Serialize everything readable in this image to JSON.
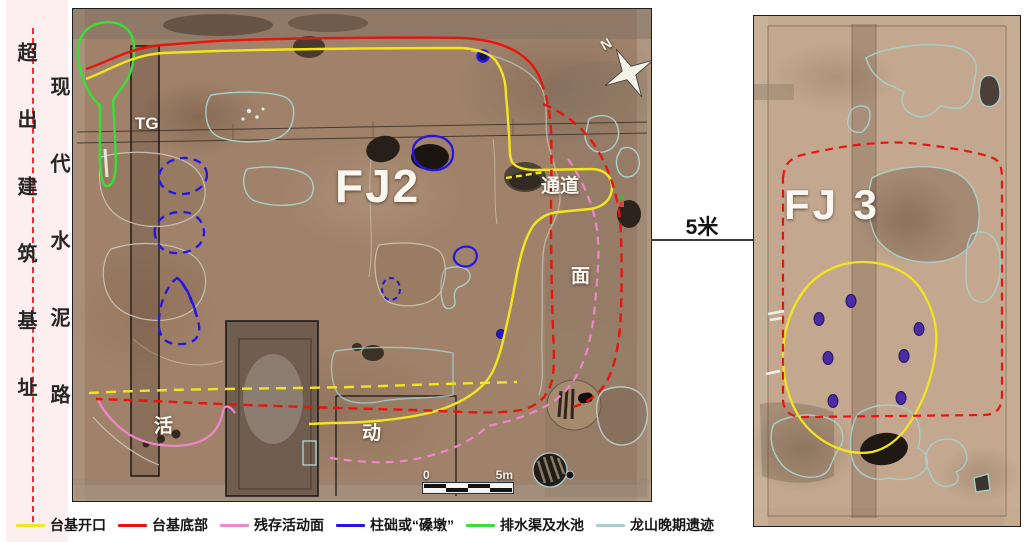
{
  "side_panel": {
    "outside_label": "超出建筑基址",
    "road_label": "现代水泥路"
  },
  "fj2": {
    "title": "FJ2",
    "trench_label": "TG",
    "passage_label": "通道",
    "surface_label": "面",
    "activity_char_1": "活",
    "activity_char_2": "动",
    "north_label": "N",
    "scale_zero": "0",
    "scale_end": "5m"
  },
  "gap": {
    "distance_label": "5米"
  },
  "fj3": {
    "title": "FJ 3"
  },
  "legend": {
    "items": [
      {
        "label": "台基开口",
        "color": "#f3e51d"
      },
      {
        "label": "台基底部",
        "color": "#e8140e"
      },
      {
        "label": "残存活动面",
        "color": "#ef86ca"
      },
      {
        "label": "柱础或“磉墩”",
        "color": "#2415e6"
      },
      {
        "label": "排水渠及水池",
        "color": "#38df38"
      },
      {
        "label": "龙山晚期遗迹",
        "color": "#a9cfca"
      }
    ]
  }
}
